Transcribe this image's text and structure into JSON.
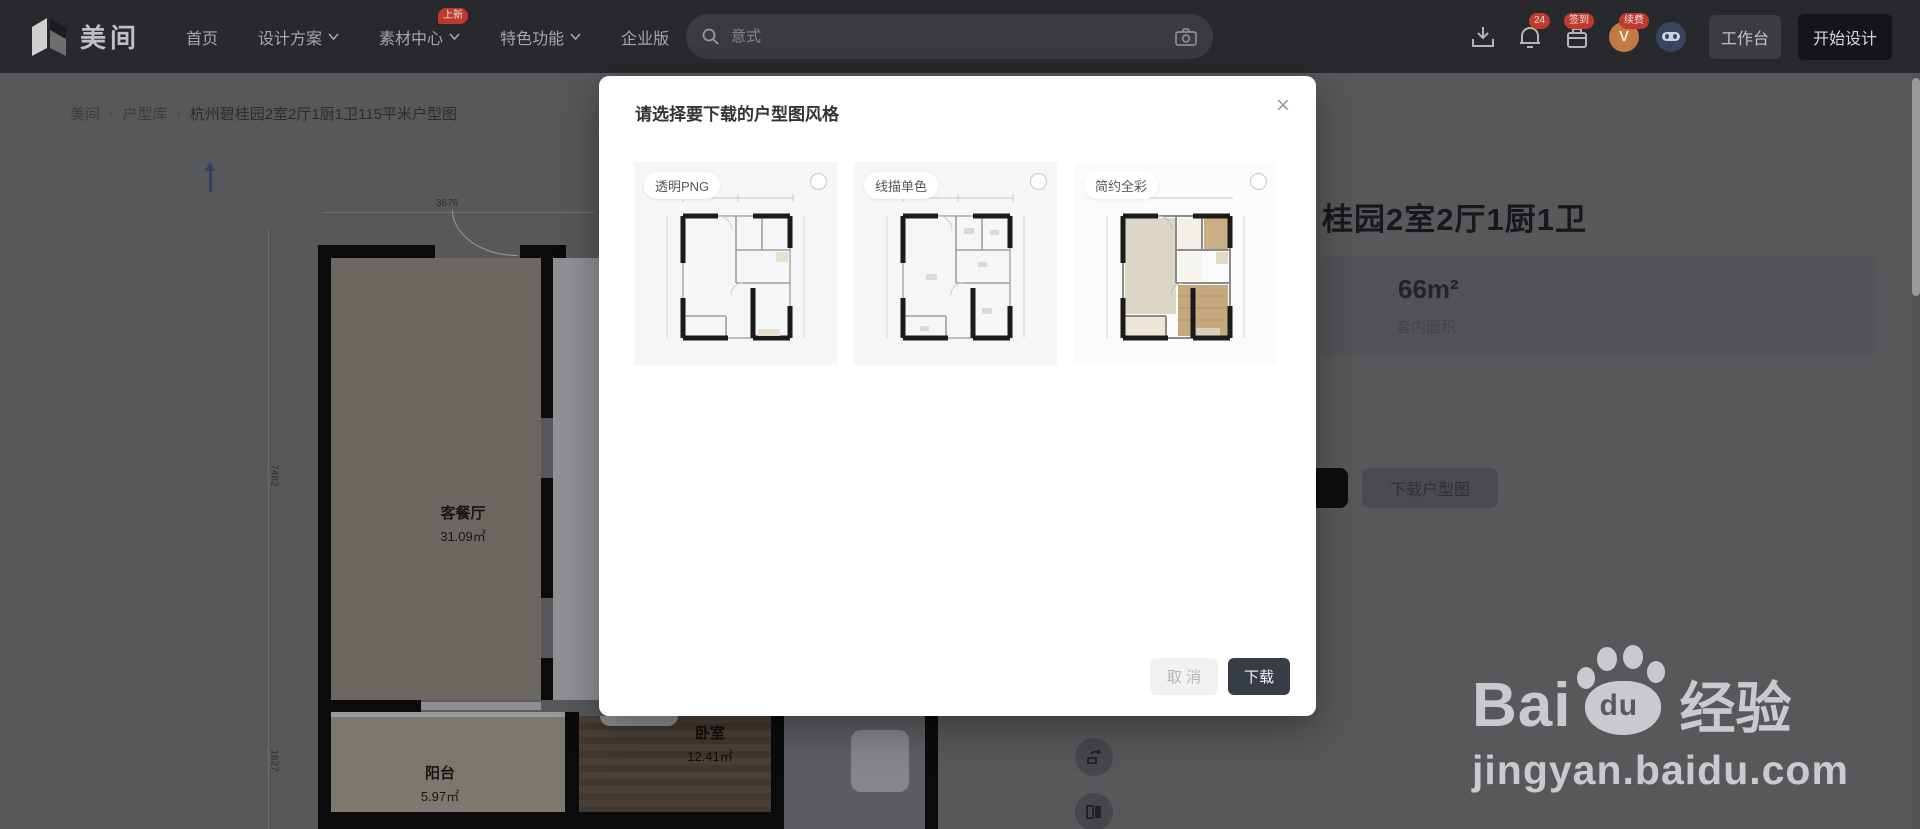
{
  "colors": {
    "nav_bg": "#28292c",
    "badge_red": "#bf3a2d",
    "modal_confirm_bg": "#373d47",
    "overlay_page_bg": "#57585a",
    "bedroom_wood": "#463c33"
  },
  "nav": {
    "logo": "美间",
    "items": [
      {
        "label": "首页"
      },
      {
        "label": "设计方案"
      },
      {
        "label": "素材中心"
      },
      {
        "label": "特色功能"
      },
      {
        "label": "企业版"
      }
    ],
    "new_badge": "上新",
    "search_placeholder": "意式",
    "notification_count": "24",
    "checkin_badge": "签到",
    "renew_badge": "续费",
    "workspace": "工作台",
    "start_design": "开始设计"
  },
  "breadcrumb": {
    "home": "美间",
    "separator": "›",
    "section": "户型库",
    "current": "杭州碧桂园2室2厅1厨1卫115平米户型图"
  },
  "floor_plan": {
    "dim_top": "3676",
    "dim_left_top": "7482",
    "dim_left_bottom": "1627",
    "rooms": [
      {
        "name": "客餐厅",
        "area": "31.09㎡"
      },
      {
        "name": "阳台",
        "area": "5.97㎡"
      },
      {
        "name": "卧室",
        "area": "12.41㎡"
      }
    ]
  },
  "detail_panel": {
    "title_visible": "桂园2室2厅1厨1卫",
    "area_value": "66m²",
    "area_label": "套内面积",
    "download_button": "下载户型图"
  },
  "modal": {
    "title": "请选择要下载的户型图风格",
    "close": "×",
    "options": [
      {
        "label": "透明PNG"
      },
      {
        "label": "线描单色"
      },
      {
        "label": "简约全彩"
      }
    ],
    "cancel": "取 消",
    "confirm": "下载"
  },
  "watermark": {
    "brand_prefix": "Bai",
    "brand_paw": "du",
    "brand_suffix": "经验",
    "url": "jingyan.baidu.com"
  }
}
